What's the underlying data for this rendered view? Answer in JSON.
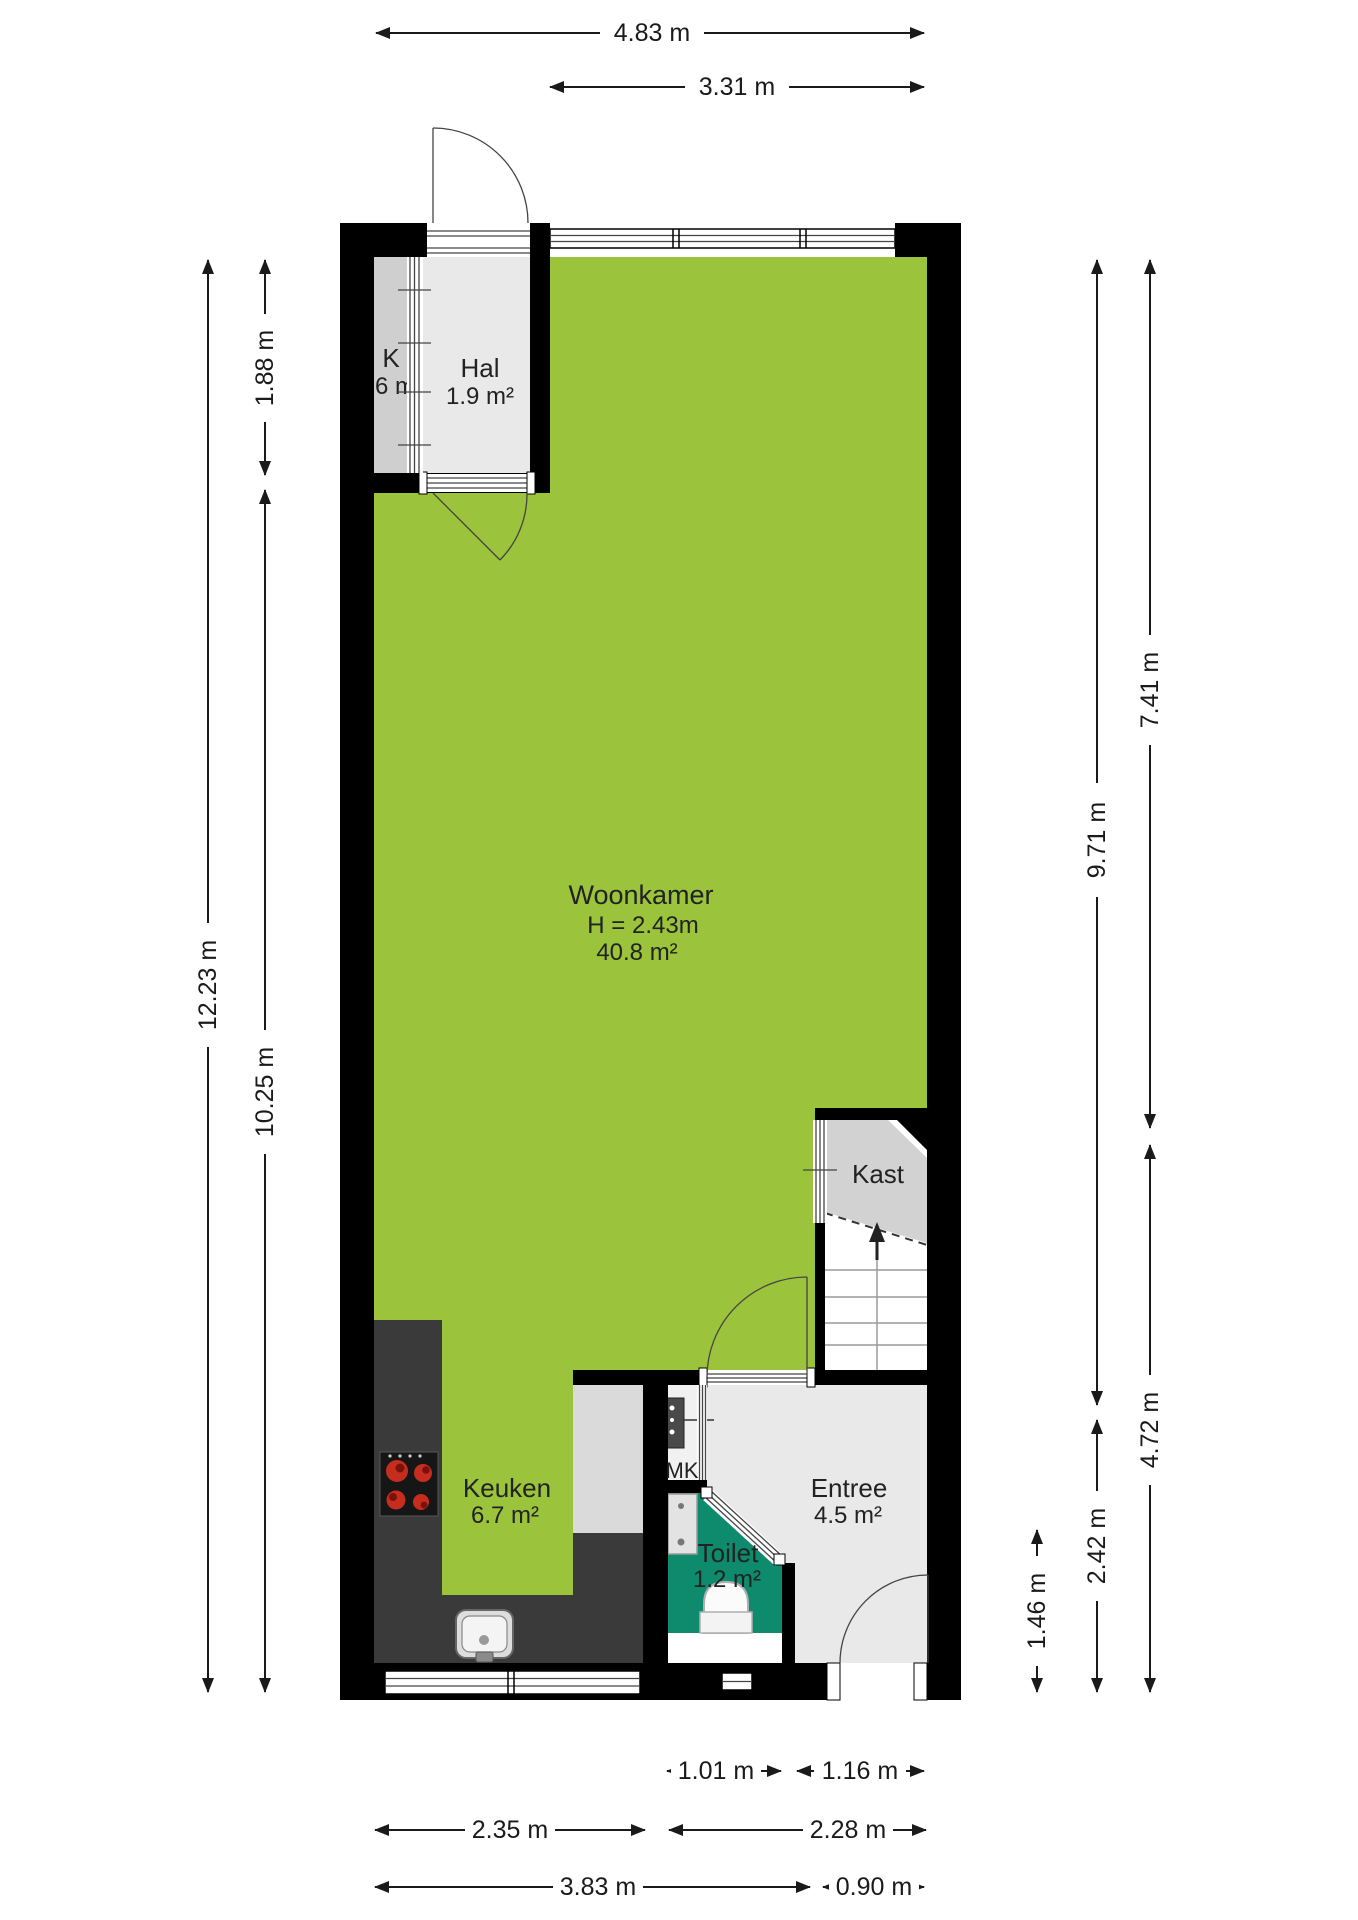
{
  "title": "Begane grond plattegrond",
  "rooms": {
    "woonkamer": {
      "name": "Woonkamer",
      "height_note": "H = 2.43m",
      "area": "40.8 m²"
    },
    "hal": {
      "name": "Hal",
      "area": "1.9 m²"
    },
    "k": {
      "name": "K",
      "area": "0.6 m²"
    },
    "kast": {
      "name": "Kast"
    },
    "mk": {
      "name": "MK"
    },
    "keuken": {
      "name": "Keuken",
      "area": "6.7 m²"
    },
    "toilet": {
      "name": "Toilet",
      "area": "1.2 m²"
    },
    "entree": {
      "name": "Entree",
      "area": "4.5 m²"
    }
  },
  "dimensions": {
    "top_total": "4.83 m",
    "top_partial": "3.31 m",
    "left_hal": "1.88 m",
    "left_total": "12.23 m",
    "left_lower": "10.25 m",
    "right_inner_upper": "9.71 m",
    "right_outer_upper": "7.41 m",
    "right_outer_lower": "4.72 m",
    "right_inner_lower": "2.42 m",
    "right_toilet": "1.46 m",
    "bottom_toilet": "1.01 m",
    "bottom_entree": "1.16 m",
    "bottom_keuken": "2.35 m",
    "bottom_toilet_entree": "2.28 m",
    "bottom_left_total": "3.83 m",
    "bottom_door": "0.90 m"
  },
  "colors": {
    "living": "#9bc33b",
    "toilet": "#0e8a6c",
    "light": "#e9e9e9",
    "mid": "#cfcfcf",
    "kast": "#d2d2d2",
    "unit": "#dadada",
    "counter": "#3a3a3a",
    "wall": "#000000",
    "stove": "#161616",
    "burner": "#c62d1f",
    "burner_dark": "#7a120c",
    "dim": "#1a1a1a",
    "door": "#444444",
    "tread": "#9a9a9a"
  }
}
